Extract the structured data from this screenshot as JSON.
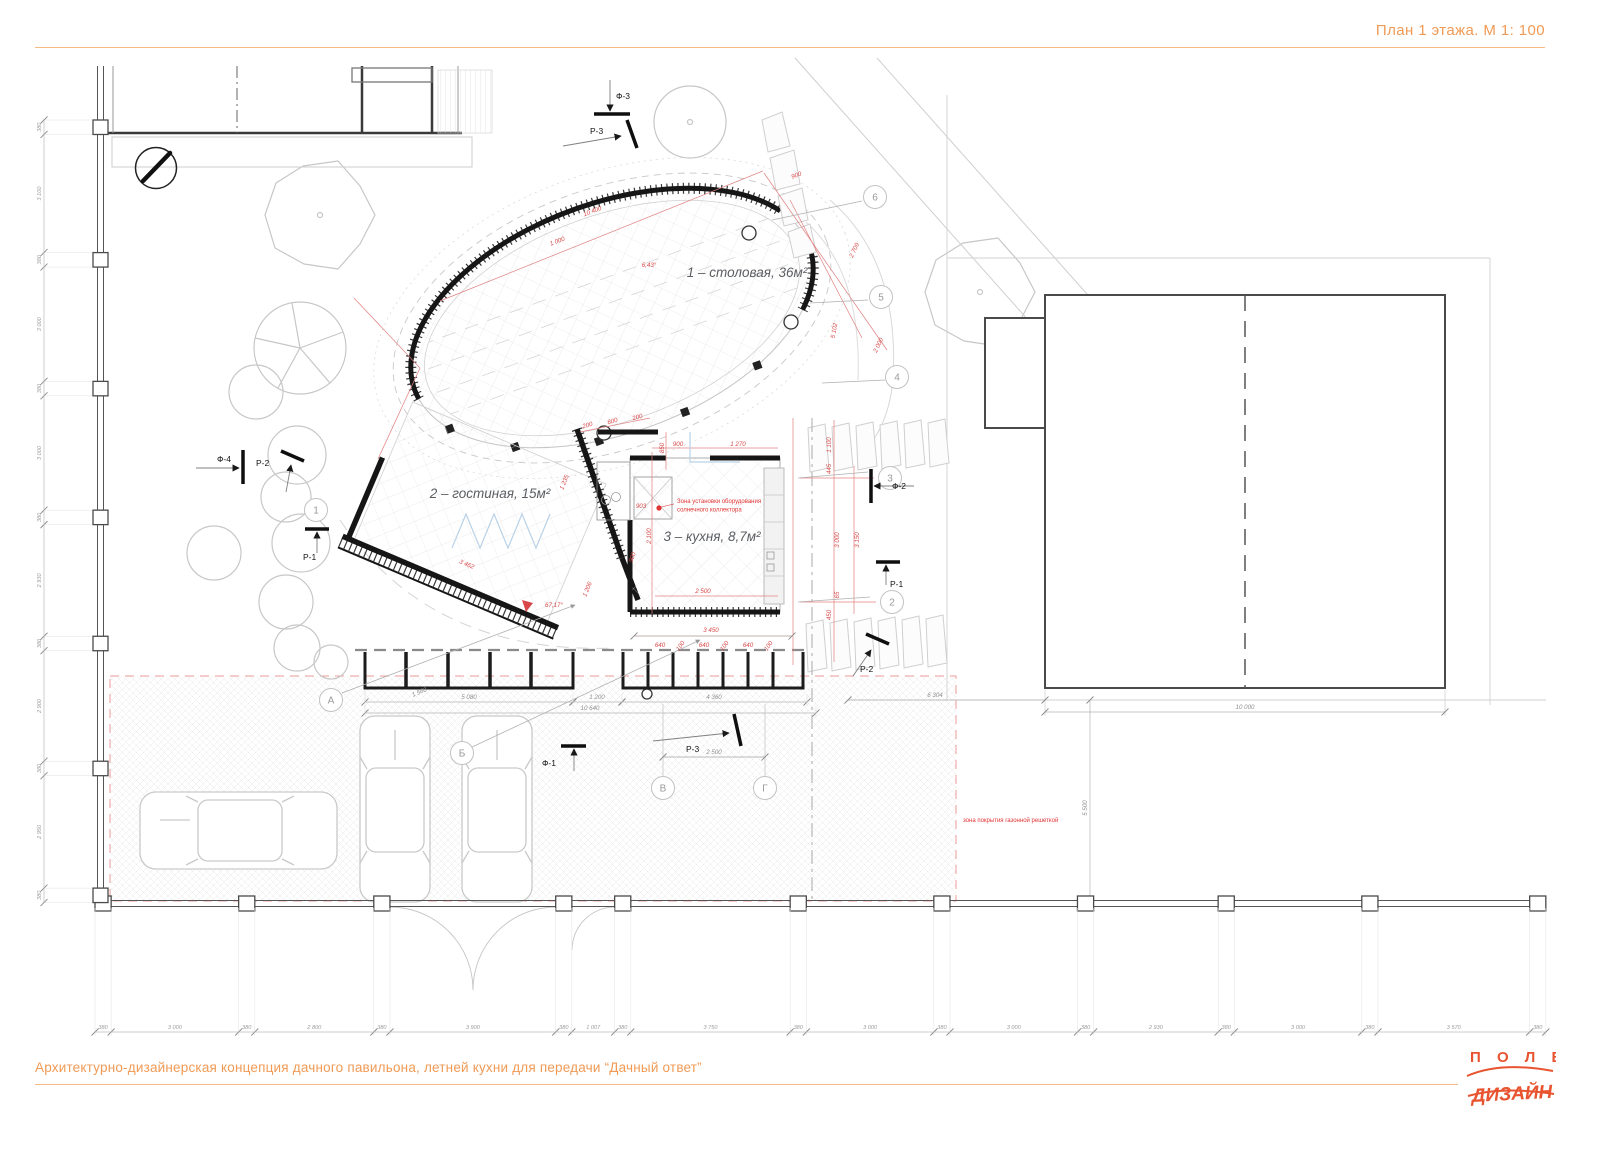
{
  "header": {
    "title": "План 1 этажа. М 1: 100"
  },
  "footer": {
    "caption": "Архитектурно-дизайнерская концепция дачного павильона, летней кухни для передачи “Дачный ответ”",
    "logo_top": "П О Л Е",
    "logo_bottom": "ДИЗАЙН"
  },
  "colors": {
    "accent_orange": "#F09A55",
    "logo_red": "#E85430",
    "annotation_red": "#E03333",
    "dimension_red": "#D84848",
    "wall_black": "#1a1a1a",
    "drawing_gray": "#9b9b9b",
    "light_gray": "#c9c9c9"
  },
  "rooms": [
    {
      "id": "dining",
      "label": "1 – столовая, 36м²",
      "x": 747,
      "y": 277
    },
    {
      "id": "living",
      "label": "2 – гостиная, 15м²",
      "x": 490,
      "y": 498
    },
    {
      "id": "kitchen",
      "label": "3 – кухня, 8,7м²",
      "x": 712,
      "y": 541
    }
  ],
  "notes": [
    {
      "id": "solar-note",
      "lines": [
        "Зона установки оборудования",
        "солнечного коллектора"
      ],
      "x": 677,
      "y": 503
    },
    {
      "id": "lawn-note",
      "lines": [
        "зона покрытия газонной решеткой"
      ],
      "x": 963,
      "y": 822
    }
  ],
  "axes": {
    "letters": [
      {
        "label": "А",
        "x": 331,
        "y": 700
      },
      {
        "label": "Б",
        "x": 462,
        "y": 753
      },
      {
        "label": "В",
        "x": 663,
        "y": 788
      },
      {
        "label": "Г",
        "x": 765,
        "y": 788
      }
    ],
    "numbers": [
      {
        "label": "1",
        "x": 316,
        "y": 510
      },
      {
        "label": "2",
        "x": 892,
        "y": 602
      },
      {
        "label": "3",
        "x": 890,
        "y": 478
      },
      {
        "label": "4",
        "x": 897,
        "y": 377
      },
      {
        "label": "5",
        "x": 881,
        "y": 297
      },
      {
        "label": "6",
        "x": 875,
        "y": 197
      }
    ]
  },
  "section_markers": [
    {
      "label": "Ф-3",
      "tx": 616,
      "ty": 99,
      "anchor": "start",
      "bar": [
        594,
        114,
        630,
        114
      ],
      "arrow": [
        610,
        80,
        610,
        111
      ]
    },
    {
      "label": "Р-3",
      "tx": 590,
      "ty": 134,
      "anchor": "start",
      "bar": [
        627,
        120,
        637,
        148
      ],
      "arrow": [
        563,
        146,
        621,
        136
      ]
    },
    {
      "label": "Ф-4",
      "tx": 231,
      "ty": 462,
      "anchor": "end",
      "bar": [
        243,
        450,
        243,
        484
      ],
      "arrow": [
        196,
        468,
        239,
        468
      ]
    },
    {
      "label": "Р-2",
      "tx": 256,
      "ty": 466,
      "anchor": "start",
      "bar": [
        281,
        451,
        304,
        461
      ],
      "arrow": [
        286,
        492,
        291,
        465
      ]
    },
    {
      "label": "Р-1",
      "tx": 303,
      "ty": 560,
      "anchor": "start",
      "bar": [
        305,
        529,
        329,
        529
      ],
      "arrow": [
        317,
        553,
        317,
        532
      ]
    },
    {
      "label": "Ф-2",
      "tx": 892,
      "ty": 489,
      "anchor": "start",
      "bar": [
        871,
        469,
        871,
        503
      ],
      "arrow": [
        914,
        486,
        874,
        486
      ]
    },
    {
      "label": "Р-1",
      "tx": 890,
      "ty": 587,
      "anchor": "start",
      "bar": [
        876,
        562,
        900,
        562
      ],
      "arrow": [
        886,
        585,
        886,
        565
      ]
    },
    {
      "label": "Р-2",
      "tx": 860,
      "ty": 672,
      "anchor": "start",
      "bar": [
        866,
        634,
        889,
        644
      ],
      "arrow": [
        853,
        676,
        871,
        650
      ]
    },
    {
      "label": "Ф-1",
      "tx": 556,
      "ty": 766,
      "anchor": "end",
      "bar": [
        561,
        746,
        586,
        746
      ],
      "arrow": [
        574,
        771,
        574,
        749
      ]
    },
    {
      "label": "Р-3",
      "tx": 686,
      "ty": 752,
      "anchor": "start",
      "bar": [
        734,
        714,
        741,
        746
      ],
      "arrow": [
        653,
        741,
        729,
        733
      ]
    }
  ],
  "dim_labels": [
    {
      "t": "10 400",
      "x": 593,
      "y": 213,
      "r": -21,
      "c": "r"
    },
    {
      "t": "1 000",
      "x": 558,
      "y": 243,
      "r": -21,
      "c": "r"
    },
    {
      "t": "6,43°",
      "x": 649,
      "y": 267,
      "r": 0,
      "c": "r"
    },
    {
      "t": "900",
      "x": 797,
      "y": 177,
      "r": -20,
      "c": "r"
    },
    {
      "t": "2 709",
      "x": 856,
      "y": 251,
      "r": -65,
      "c": "r"
    },
    {
      "t": "5 102",
      "x": 836,
      "y": 331,
      "r": -80,
      "c": "r"
    },
    {
      "t": "2 000",
      "x": 880,
      "y": 346,
      "r": -65,
      "c": "r"
    },
    {
      "t": "200",
      "x": 588,
      "y": 427,
      "r": -16,
      "c": "r"
    },
    {
      "t": "800",
      "x": 613,
      "y": 423,
      "r": -16,
      "c": "r"
    },
    {
      "t": "200",
      "x": 638,
      "y": 419,
      "r": -16,
      "c": "r"
    },
    {
      "t": "850",
      "x": 664,
      "y": 448,
      "r": -90,
      "c": "r"
    },
    {
      "t": "900",
      "x": 678,
      "y": 446,
      "r": 0,
      "c": "r"
    },
    {
      "t": "1 270",
      "x": 738,
      "y": 446,
      "r": 0,
      "c": "r"
    },
    {
      "t": "903",
      "x": 641,
      "y": 508,
      "r": 0,
      "c": "r"
    },
    {
      "t": "2 100",
      "x": 651,
      "y": 536,
      "r": -90,
      "c": "r"
    },
    {
      "t": "900",
      "x": 634,
      "y": 558,
      "r": -68,
      "c": "r"
    },
    {
      "t": "2 500",
      "x": 703,
      "y": 593,
      "r": 0,
      "c": "r"
    },
    {
      "t": "3 450",
      "x": 711,
      "y": 632,
      "r": 0,
      "c": "r"
    },
    {
      "t": "1 100",
      "x": 831,
      "y": 445,
      "r": -90,
      "c": "r"
    },
    {
      "t": "445",
      "x": 831,
      "y": 469,
      "r": -90,
      "c": "r"
    },
    {
      "t": "3 000",
      "x": 839,
      "y": 540,
      "r": -90,
      "c": "r"
    },
    {
      "t": "3 150",
      "x": 859,
      "y": 540,
      "r": -90,
      "c": "r"
    },
    {
      "t": "65",
      "x": 839,
      "y": 595,
      "r": -90,
      "c": "r"
    },
    {
      "t": "450",
      "x": 831,
      "y": 615,
      "r": -90,
      "c": "r"
    },
    {
      "t": "3 462",
      "x": 466,
      "y": 566,
      "r": 23,
      "c": "r"
    },
    {
      "t": "1 235",
      "x": 566,
      "y": 483,
      "r": -68,
      "c": "r"
    },
    {
      "t": "1 206",
      "x": 589,
      "y": 590,
      "r": -68,
      "c": "r"
    },
    {
      "t": "67,17°",
      "x": 554,
      "y": 607,
      "r": 0,
      "c": "r"
    },
    {
      "t": "640",
      "x": 660,
      "y": 647,
      "r": 0,
      "c": "r"
    },
    {
      "t": "100",
      "x": 682,
      "y": 647,
      "r": -55,
      "c": "r"
    },
    {
      "t": "640",
      "x": 704,
      "y": 647,
      "r": 0,
      "c": "r"
    },
    {
      "t": "100",
      "x": 726,
      "y": 647,
      "r": -55,
      "c": "r"
    },
    {
      "t": "640",
      "x": 748,
      "y": 647,
      "r": 0,
      "c": "r"
    },
    {
      "t": "100",
      "x": 770,
      "y": 647,
      "r": -55,
      "c": "r"
    },
    {
      "t": "5 080",
      "x": 469,
      "y": 699,
      "r": 0,
      "c": "g"
    },
    {
      "t": "1 200",
      "x": 597,
      "y": 699,
      "r": 0,
      "c": "g"
    },
    {
      "t": "4 360",
      "x": 714,
      "y": 699,
      "r": 0,
      "c": "g"
    },
    {
      "t": "10 640",
      "x": 590,
      "y": 710,
      "r": 0,
      "c": "g"
    },
    {
      "t": "1 560",
      "x": 420,
      "y": 694,
      "r": -22,
      "c": "g"
    },
    {
      "t": "2 500",
      "x": 714,
      "y": 754,
      "r": 0,
      "c": "g"
    },
    {
      "t": "10 000",
      "x": 1245,
      "y": 709,
      "r": 0,
      "c": "g"
    },
    {
      "t": "6 304",
      "x": 935,
      "y": 697,
      "r": 0,
      "c": "g"
    },
    {
      "t": "5 500",
      "x": 1087,
      "y": 808,
      "r": -90,
      "c": "g"
    }
  ],
  "fence": {
    "bottom_values": [
      "380",
      "3 000",
      "380",
      "2 800",
      "380",
      "3 900",
      "380",
      "1 007",
      "380",
      "3 750",
      "380",
      "3 000",
      "380",
      "3 000",
      "380",
      "2 930",
      "380",
      "3 000",
      "380",
      "3 570",
      "380"
    ],
    "left_values": [
      "380",
      "3 100",
      "380",
      "3 000",
      "380",
      "3 000",
      "380",
      "2 930",
      "380",
      "2 900",
      "380",
      "2 950",
      "380"
    ]
  }
}
